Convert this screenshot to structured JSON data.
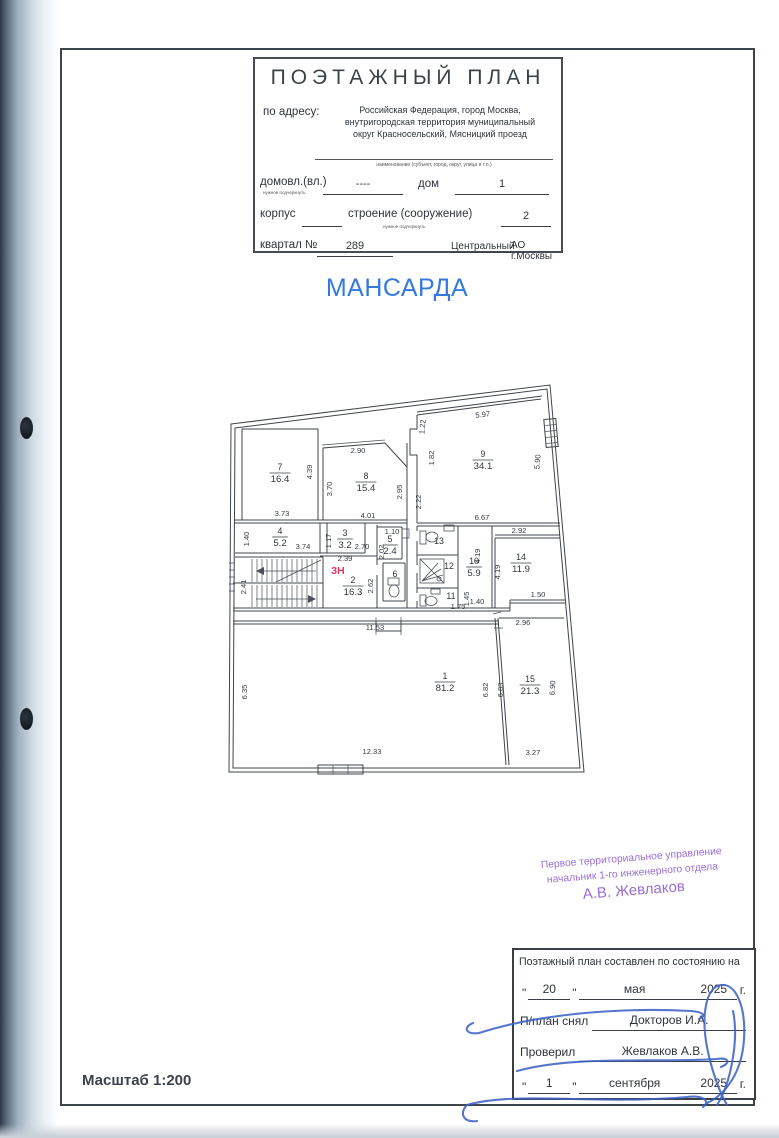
{
  "page": {
    "floor_title": "МАНСАРДА",
    "scale_label": "Масштаб 1:200",
    "colors": {
      "floor_title_blue": "#3579dd",
      "stamp_purple": "#9a6ed8",
      "zone_red": "#e0395f",
      "signature_blue": "#3f63c6"
    }
  },
  "title_block": {
    "title": "ПОЭТАЖНЫЙ ПЛАН",
    "address_label": "по адресу:",
    "address_line1": "Российская Федерация, город Москва,",
    "address_line2": "внутригородская территория муниципальный",
    "address_line3": "округ Красносельский, Мясницкий проезд",
    "address_caption": "наименование (субъект, город, округ, улица и т.п.)",
    "row1": {
      "label": "домовл.(вл.)",
      "note": "нужное подчеркнуть",
      "value1": "----",
      "label2": "дом",
      "value2": "1"
    },
    "row2": {
      "label": "корпус",
      "value1": "",
      "label2": "строение (сооружение)",
      "note": "нужное подчеркнуть",
      "value2": "2"
    },
    "row3": {
      "label": "квартал №",
      "value1": "289",
      "district": "Центральный",
      "district2": "АО г.Москвы"
    }
  },
  "plan": {
    "zone_label": {
      "text": "3Н",
      "x": 120,
      "y": 201
    },
    "rooms": [
      {
        "num": "1",
        "area": "81.2",
        "x": 227,
        "y": 309
      },
      {
        "num": "2",
        "area": "16.3",
        "x": 135,
        "y": 213
      },
      {
        "num": "3",
        "area": "3.2",
        "x": 127,
        "y": 166
      },
      {
        "num": "4",
        "area": "5.2",
        "x": 62,
        "y": 164
      },
      {
        "num": "5",
        "area": "2.4",
        "x": 172,
        "y": 172
      },
      {
        "num": "6",
        "area": "",
        "x": 177,
        "y": 207
      },
      {
        "num": "7",
        "area": "16.4",
        "x": 62,
        "y": 100
      },
      {
        "num": "8",
        "area": "15.4",
        "x": 148,
        "y": 109
      },
      {
        "num": "9",
        "area": "34.1",
        "x": 265,
        "y": 87
      },
      {
        "num": "10",
        "area": "5.9",
        "x": 256,
        "y": 194
      },
      {
        "num": "11",
        "area": "",
        "x": 233,
        "y": 229
      },
      {
        "num": "12",
        "area": "",
        "x": 231,
        "y": 199
      },
      {
        "num": "13",
        "area": "",
        "x": 221,
        "y": 174
      },
      {
        "num": "14",
        "area": "11.9",
        "x": 303,
        "y": 190
      },
      {
        "num": "15",
        "area": "21.3",
        "x": 312,
        "y": 312
      }
    ],
    "dimensions": [
      {
        "t": "3.73",
        "x": 64,
        "y": 143,
        "r": 0
      },
      {
        "t": "4.39",
        "x": 94,
        "y": 99,
        "r": -90
      },
      {
        "t": "2.90",
        "x": 140,
        "y": 80,
        "r": 0
      },
      {
        "t": "3.70",
        "x": 114,
        "y": 116,
        "r": -90
      },
      {
        "t": "4.01",
        "x": 150,
        "y": 145,
        "r": 0
      },
      {
        "t": "2.95",
        "x": 184,
        "y": 119,
        "r": -90
      },
      {
        "t": "2.22",
        "x": 203,
        "y": 129,
        "r": -90
      },
      {
        "t": "5.97",
        "x": 265,
        "y": 44,
        "r": -7
      },
      {
        "t": "1.22",
        "x": 207,
        "y": 54,
        "r": -85
      },
      {
        "t": "1.82",
        "x": 216,
        "y": 85,
        "r": -90
      },
      {
        "t": "5.90",
        "x": 322,
        "y": 89,
        "r": -85
      },
      {
        "t": "6.67",
        "x": 264,
        "y": 147,
        "r": 0
      },
      {
        "t": "2.92",
        "x": 301,
        "y": 160,
        "r": 0
      },
      {
        "t": "1.40",
        "x": 31,
        "y": 166,
        "r": -90
      },
      {
        "t": "3.74",
        "x": 85,
        "y": 176,
        "r": 0
      },
      {
        "t": "1.17",
        "x": 113,
        "y": 168,
        "r": -90
      },
      {
        "t": "2.70",
        "x": 144,
        "y": 176,
        "r": 0
      },
      {
        "t": "2.39",
        "x": 127,
        "y": 188,
        "r": 0
      },
      {
        "t": "1.10",
        "x": 174,
        "y": 161,
        "r": 0
      },
      {
        "t": "2.02",
        "x": 166,
        "y": 179,
        "r": -90
      },
      {
        "t": "2.62",
        "x": 155,
        "y": 213,
        "r": -90
      },
      {
        "t": "2.41",
        "x": 28,
        "y": 214,
        "r": -90
      },
      {
        "t": "4.19",
        "x": 262,
        "y": 183,
        "r": -90
      },
      {
        "t": "4.19",
        "x": 282,
        "y": 199,
        "r": -90
      },
      {
        "t": "1.45",
        "x": 251,
        "y": 226,
        "r": -90
      },
      {
        "t": "1.75",
        "x": 240,
        "y": 236,
        "r": 0
      },
      {
        "t": "1.40",
        "x": 259,
        "y": 231,
        "r": 0
      },
      {
        "t": "1.50",
        "x": 320,
        "y": 224,
        "r": 0
      },
      {
        "t": "2.96",
        "x": 305,
        "y": 252,
        "r": 0
      },
      {
        "t": "11.53",
        "x": 157,
        "y": 257,
        "r": 0
      },
      {
        "t": "6.35",
        "x": 29,
        "y": 319,
        "r": -90
      },
      {
        "t": "12.33",
        "x": 154,
        "y": 381,
        "r": 0
      },
      {
        "t": "6.82",
        "x": 270,
        "y": 317,
        "r": -90
      },
      {
        "t": "6.83",
        "x": 285,
        "y": 317,
        "r": -90
      },
      {
        "t": "6.90",
        "x": 337,
        "y": 315,
        "r": -87
      },
      {
        "t": "3.27",
        "x": 315,
        "y": 382,
        "r": 0
      }
    ]
  },
  "stamp": {
    "line1": "Первое территориальное управление",
    "line2": "начальник 1-го инженерного отдела",
    "line3": "А.В. Жевлаков"
  },
  "footer_table": {
    "header": "Поэтажный план составлен по состоянию на",
    "quote": "\"",
    "date1": {
      "day": "20",
      "month": "мая",
      "year": "2025",
      "suffix": "г."
    },
    "row_snyal": {
      "label": "П/план снял",
      "value": "Докторов И.А."
    },
    "row_proveril": {
      "label": "Проверил",
      "value": "Жевлаков А.В."
    },
    "date2": {
      "day": "1",
      "month": "сентября",
      "year": "2025",
      "suffix": "г."
    }
  }
}
